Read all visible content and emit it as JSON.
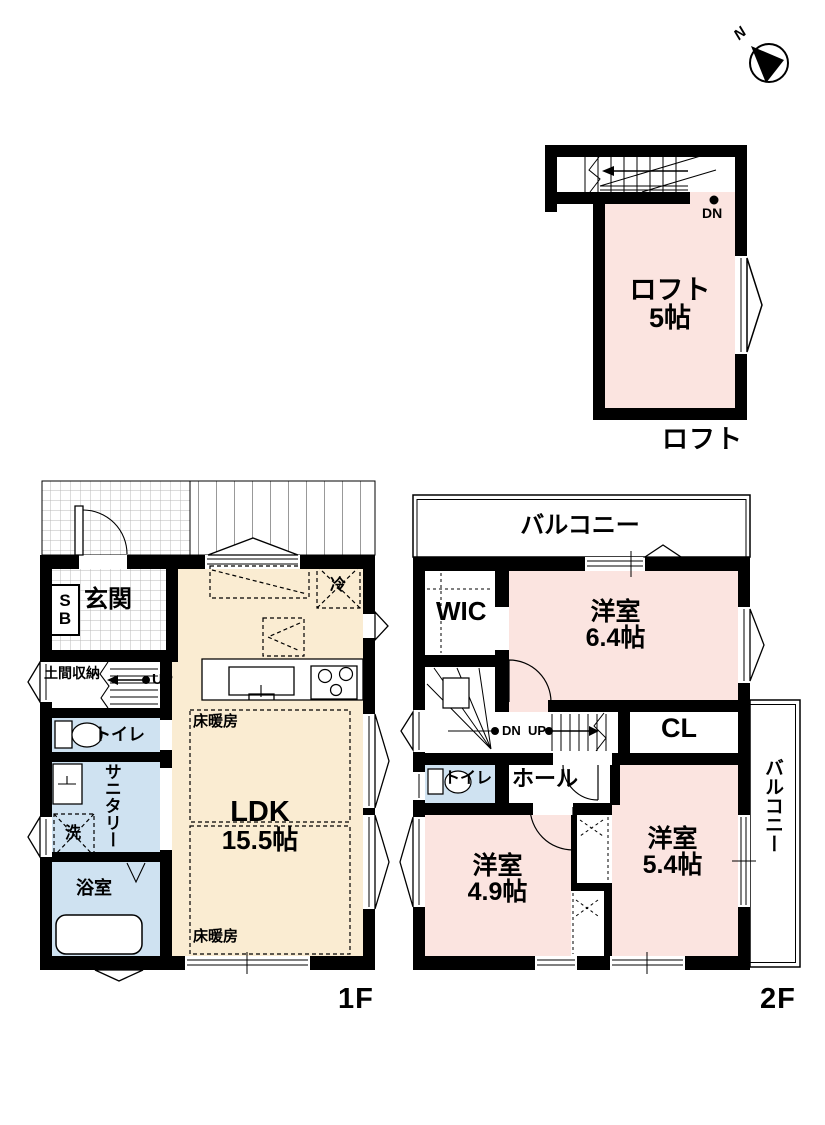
{
  "compass": {
    "north_label": "N"
  },
  "loft": {
    "room_name": "ロフト",
    "room_size": "5帖",
    "dn_label": "DN",
    "caption": "ロフト"
  },
  "f1": {
    "caption": "1F",
    "genkan": "玄関",
    "sb_line1": "S",
    "sb_line2": "B",
    "doma": "土間収納",
    "up_label": "UP",
    "toilet": "トイレ",
    "sanitary": "サニタリー",
    "washer": "洗",
    "bath": "浴室",
    "ldk_name": "LDK",
    "ldk_size": "15.5帖",
    "floor_heating": "床暖房",
    "fridge": "冷"
  },
  "f2": {
    "caption": "2F",
    "balcony": "バルコニー",
    "wic": "WIC",
    "cl": "CL",
    "dn_label": "DN",
    "up_label": "UP",
    "toilet": "トイレ",
    "hall": "ホール",
    "room64_name": "洋室",
    "room64_size": "6.4帖",
    "room49_name": "洋室",
    "room49_size": "4.9帖",
    "room54_name": "洋室",
    "room54_size": "5.4帖"
  },
  "colors": {
    "wall": "#000000",
    "room_pink": "#fbe4e0",
    "room_cream": "#faecd2",
    "room_blue": "#cfe2f1"
  }
}
